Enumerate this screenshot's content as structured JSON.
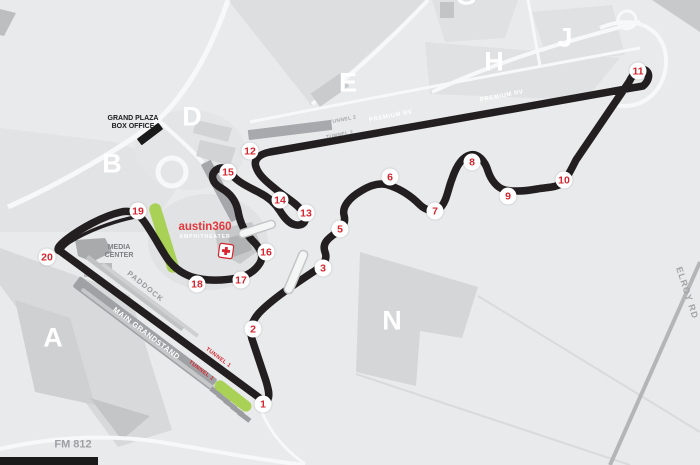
{
  "map": {
    "title": "Circuit of The Americas facility map",
    "colors": {
      "background": "#e9eaeb",
      "track": "#231f20",
      "turn_red": "#d6252e",
      "austin_red": "#e2373b",
      "grass_green": "#a8d155",
      "area_letter_white": "#ffffff",
      "road_gray": "#b3b5b7"
    },
    "area_labels": [
      {
        "label": "A",
        "x": 53,
        "y": 338
      },
      {
        "label": "B",
        "x": 112,
        "y": 164
      },
      {
        "label": "D",
        "x": 192,
        "y": 117
      },
      {
        "label": "E",
        "x": 348,
        "y": 83
      },
      {
        "label": "G",
        "x": 466,
        "y": -4
      },
      {
        "label": "H",
        "x": 494,
        "y": 62
      },
      {
        "label": "J",
        "x": 565,
        "y": 38
      },
      {
        "label": "N",
        "x": 392,
        "y": 321
      }
    ],
    "turns": [
      {
        "n": "1",
        "x": 263,
        "y": 404
      },
      {
        "n": "2",
        "x": 253,
        "y": 329
      },
      {
        "n": "3",
        "x": 323,
        "y": 268
      },
      {
        "n": "5",
        "x": 340,
        "y": 229
      },
      {
        "n": "6",
        "x": 390,
        "y": 177
      },
      {
        "n": "7",
        "x": 435,
        "y": 211
      },
      {
        "n": "8",
        "x": 472,
        "y": 162
      },
      {
        "n": "9",
        "x": 508,
        "y": 196
      },
      {
        "n": "10",
        "x": 564,
        "y": 180
      },
      {
        "n": "11",
        "x": 638,
        "y": 71
      },
      {
        "n": "12",
        "x": 250,
        "y": 151
      },
      {
        "n": "13",
        "x": 306,
        "y": 213
      },
      {
        "n": "14",
        "x": 280,
        "y": 200
      },
      {
        "n": "15",
        "x": 228,
        "y": 172
      },
      {
        "n": "16",
        "x": 266,
        "y": 252
      },
      {
        "n": "17",
        "x": 241,
        "y": 280
      },
      {
        "n": "18",
        "x": 197,
        "y": 284
      },
      {
        "n": "19",
        "x": 138,
        "y": 211
      },
      {
        "n": "20",
        "x": 47,
        "y": 257
      }
    ],
    "labels": {
      "grand_plaza_line1": "GRAND PLAZA",
      "grand_plaza_line2": "BOX OFFICE",
      "media_center_line1": "MEDIA",
      "media_center_line2": "CENTER",
      "paddock": "PADDOCK",
      "main_grandstand": "MAIN GRANDSTAND",
      "premium_rv": "PREMIUM RV",
      "tunnel_1": "TUNNEL 1",
      "tunnel_2": "TUNNEL 2",
      "austin360": "austin360",
      "amphitheater": "AMPHITHEATER",
      "fm_812": "FM 812",
      "elroy_rd": "ELROY RD"
    }
  }
}
